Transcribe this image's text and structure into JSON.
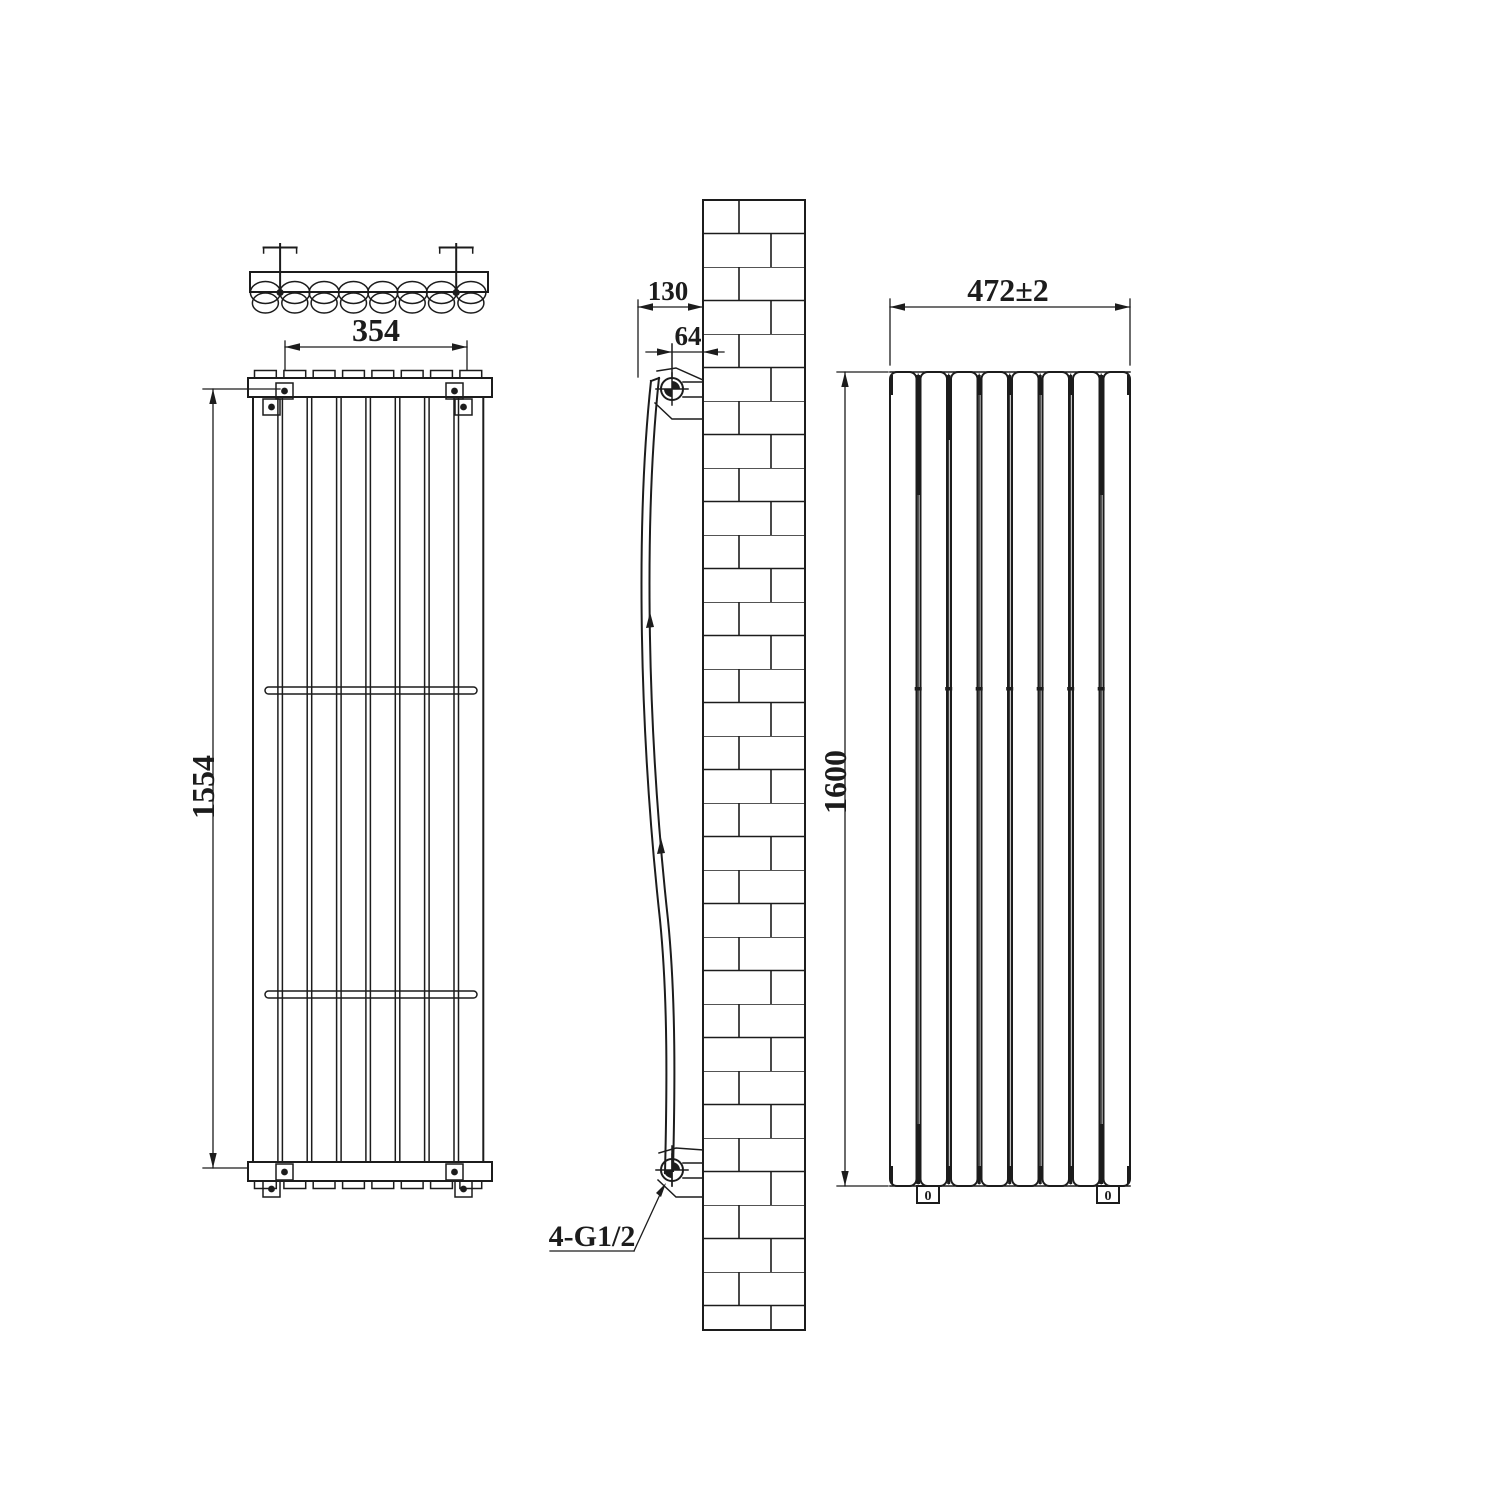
{
  "colors": {
    "line": "#1c1c1c",
    "background": "#ffffff"
  },
  "views": {
    "front": {
      "bracket_width_dim": "354",
      "height_dim": "1554"
    },
    "side": {
      "depth_dim": "130",
      "pipe_offset_dim": "64",
      "connection_note": "4-G1/2"
    },
    "rear": {
      "width_dim": "472±2",
      "height_dim": "1600",
      "left_floor_bracket_mark": "0",
      "right_floor_bracket_mark": "0"
    }
  }
}
